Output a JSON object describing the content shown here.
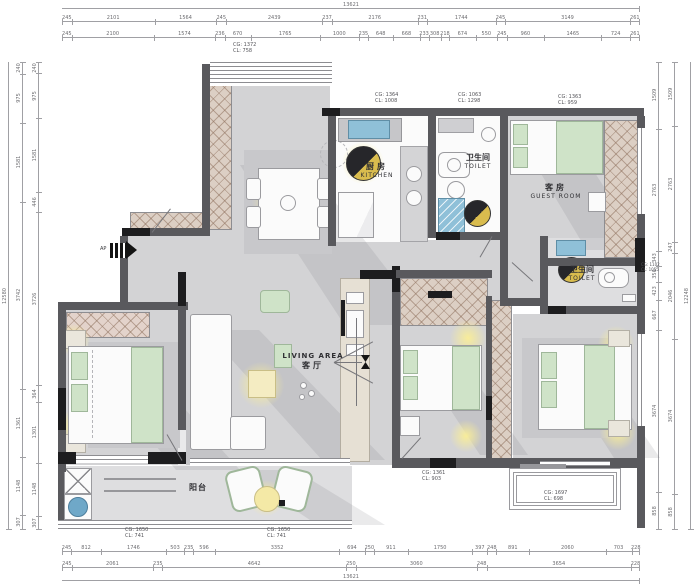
{
  "plan_title": "residential floor plan",
  "colors": {
    "wall": "#59595d",
    "wall_dark": "#1d1d1f",
    "floor": "#d3d3d5",
    "room_white": "#fbfbfb",
    "wardrobe_hatch": "#dccfc4",
    "furniture_green": "#cfe3c8",
    "light_glow": "#faee96",
    "sink_blue": "#8fc0d8",
    "rug_gray": "#c8c8cb"
  },
  "entry": {
    "label": "AP"
  },
  "rooms": {
    "kitchen": {
      "zh": "厨房",
      "en": "KITCHEN"
    },
    "toilet_top": {
      "zh": "卫生间",
      "en": "TOILET"
    },
    "guest_room": {
      "zh": "客房",
      "en": "GUEST ROOM"
    },
    "toilet_right": {
      "zh": "卫生间",
      "en": "TOILET"
    },
    "living": {
      "en": "LIVING AREA",
      "zh": "客厅"
    },
    "balcony": {
      "zh": "阳台"
    }
  },
  "annotations": [
    {
      "id": "dining-ceiling",
      "lines": [
        "CG: 1372",
        "CL: 758"
      ]
    },
    {
      "id": "kitchen-ceiling",
      "lines": [
        "CG: 1364",
        "CL: 1008"
      ]
    },
    {
      "id": "toilet-top",
      "lines": [
        "CG: 1063",
        "CL: 1298"
      ]
    },
    {
      "id": "guest-ceiling",
      "lines": [
        "CG: 1363",
        "CL: 959"
      ]
    },
    {
      "id": "toilet-right",
      "lines": [
        "CG: 1102",
        "CL: 1055"
      ]
    },
    {
      "id": "bedroom-mid",
      "lines": [
        "CG: 1361",
        "CL: 903"
      ]
    },
    {
      "id": "bay-bottom",
      "lines": [
        "CG: 1697",
        "CL: 698"
      ]
    },
    {
      "id": "balcony-left",
      "lines": [
        "CG: 1650",
        "CL: 741"
      ]
    },
    {
      "id": "balcony-right",
      "lines": [
        "CG: 1650",
        "CL: 741"
      ]
    }
  ],
  "dimensions": {
    "top": {
      "total": "13621",
      "row1": [
        "245",
        "2101",
        "1564",
        "245",
        "2439",
        "237",
        "2176",
        "231",
        "1744",
        "245",
        "3149",
        "261"
      ],
      "row2": [
        "245",
        "2100",
        "1574",
        "236",
        "670",
        "1765",
        "1000",
        "235",
        "648",
        "668",
        "233",
        "308",
        "218",
        "674",
        "550",
        "245",
        "960",
        "1465",
        "724",
        "261"
      ]
    },
    "bottom": {
      "total": "13621",
      "row1": [
        "245",
        "812",
        "1746",
        "503",
        "235",
        "596",
        "3352",
        "694",
        "250",
        "911",
        "1750",
        "397",
        "248",
        "891",
        "2060",
        "703",
        "228"
      ],
      "row2": [
        "245",
        "2061",
        "235",
        "4642",
        "250",
        "3060",
        "248",
        "3654",
        "228"
      ]
    },
    "left": {
      "total": "12580",
      "row1": [
        "240",
        "975",
        "1581",
        "3742",
        "1361",
        "1148",
        "307"
      ],
      "row2": [
        "240",
        "975",
        "1581",
        "446",
        "3726",
        "364",
        "1301",
        "1148",
        "307"
      ]
    },
    "right": {
      "total": "12248",
      "row1": [
        "1509",
        "2763",
        "343",
        "356",
        "423",
        "667",
        "3674",
        "858"
      ],
      "row2": [
        "1509",
        "2763",
        "247",
        "2046",
        "3674",
        "858"
      ]
    }
  }
}
